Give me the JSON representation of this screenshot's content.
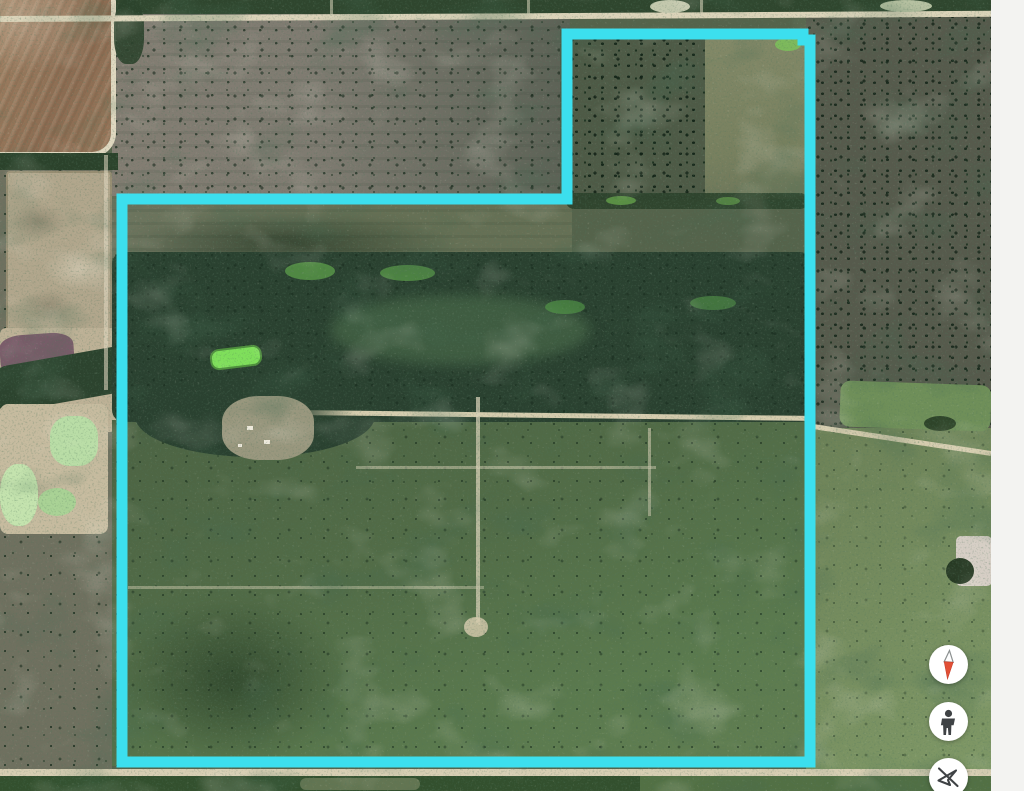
{
  "window": {
    "width": 1024,
    "height": 791,
    "background": "#f3f3f1"
  },
  "map": {
    "kind": "satellite-aerial",
    "description": "Aerial satellite view of rural ranch land with a highlighted parcel boundary overlay",
    "boundary": {
      "color": "#3cdfee",
      "stroke_width": 11,
      "closed": true,
      "points": [
        [
          567,
          34
        ],
        [
          803,
          34
        ],
        [
          803,
          40
        ],
        [
          810,
          40
        ],
        [
          810,
          762
        ],
        [
          122,
          762
        ],
        [
          122,
          199
        ],
        [
          567,
          199
        ]
      ]
    },
    "palette": {
      "scrub_green": "#55634b",
      "dense_forest": "#2a4130",
      "pasture_green": "#6c8157",
      "plowed_field_brown": "#8c6c52",
      "dirt_road_tan": "#d7ceb3",
      "quarry_tan": "#b1a68c",
      "pond_mint": "#b9dda6",
      "pond_bright_green": "#7fdf5b",
      "spoil_purple": "#7b5c6a"
    },
    "features": [
      "plowed brown field (top left)",
      "quarry pits with mint-green ponds (left edge)",
      "gray-green speckled scrub (upper notch area)",
      "dense woodland band across middle of parcel",
      "bright green stock pond inside woodland",
      "dirt roads and seismic trail grid",
      "hedgerows and smooth pasture (top right of parcel)"
    ]
  },
  "panel": {
    "background": "#f3f3f1"
  },
  "controls": {
    "button_background": "#ffffff",
    "buttons": [
      {
        "id": "compass",
        "icon": "compass-needle-icon",
        "colors": {
          "needle_red": "#e25036",
          "needle_white": "#fdfdfd",
          "outline": "#8b9090"
        }
      },
      {
        "id": "street-view",
        "icon": "pegman-icon",
        "colors": {
          "glyph": "#3f4245"
        }
      },
      {
        "id": "navigation-disabled",
        "icon": "navigation-off-icon",
        "colors": {
          "glyph": "#3f4245"
        }
      }
    ]
  }
}
